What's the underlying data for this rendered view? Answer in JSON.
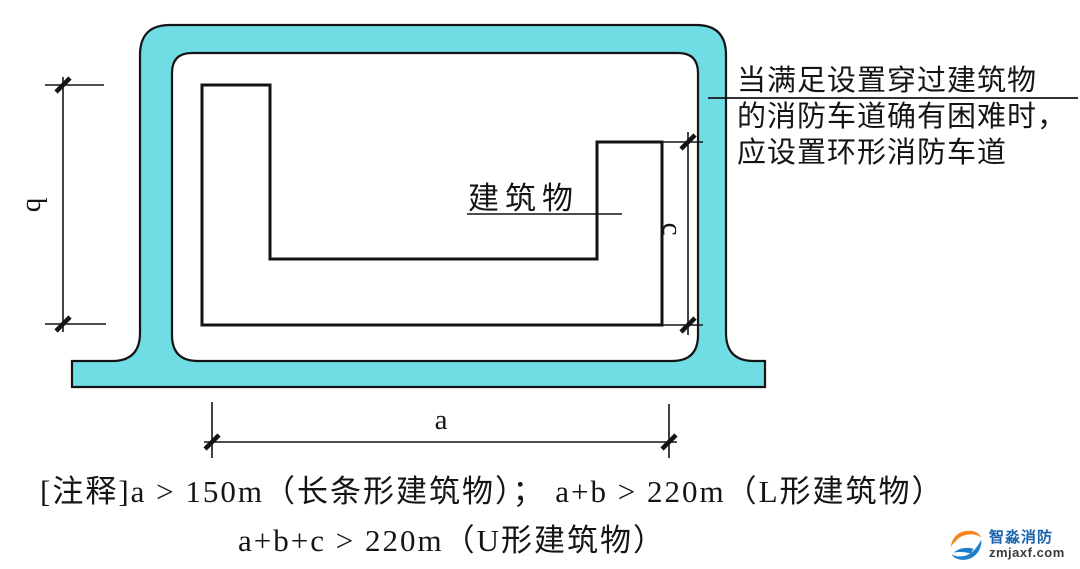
{
  "diagram": {
    "building_label": "建筑物",
    "dims": {
      "a": "a",
      "b": "b",
      "c": "c"
    },
    "annotation_lines": {
      "0": "当满足设置穿过建筑物",
      "1": "的消防车道确有困难时，",
      "2": "应设置环形消防车道"
    },
    "colors": {
      "road_fill": "#70dce4",
      "line": "#1a1a1a"
    }
  },
  "notes": {
    "line1": "[注释]a > 150m（长条形建筑物）； a+b > 220m（L形建筑物）",
    "line2": "a+b+c > 220m（U形建筑物）"
  },
  "logo": {
    "name": "智淼消防",
    "domain": "zmjaxf.com"
  }
}
